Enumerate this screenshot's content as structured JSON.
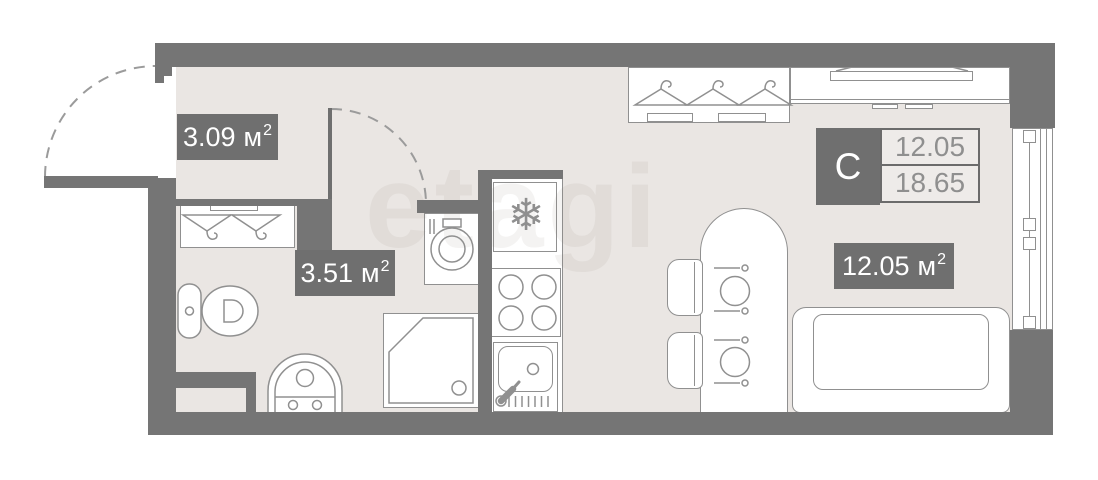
{
  "plan": {
    "watermark_text": "etagi",
    "legend": {
      "type_letter": "С",
      "area_top": "12.05",
      "area_bottom": "18.65"
    },
    "rooms": {
      "hallway": {
        "area": "3.09",
        "unit": "м",
        "sup": "2"
      },
      "bathroom": {
        "area": "3.51",
        "unit": "м",
        "sup": "2"
      },
      "living": {
        "area": "12.05",
        "unit": "м",
        "sup": "2"
      }
    },
    "icons": {
      "snowflake_glyph": "❄"
    },
    "colors": {
      "wall": "#757575",
      "floor": "#eae6e3",
      "outline": "#909090",
      "label_bg": "#6f6f6f",
      "label_text": "#ffffff",
      "legend_cell_bg": "#eeebe9",
      "legend_value_text": "#8f8f8f"
    }
  }
}
